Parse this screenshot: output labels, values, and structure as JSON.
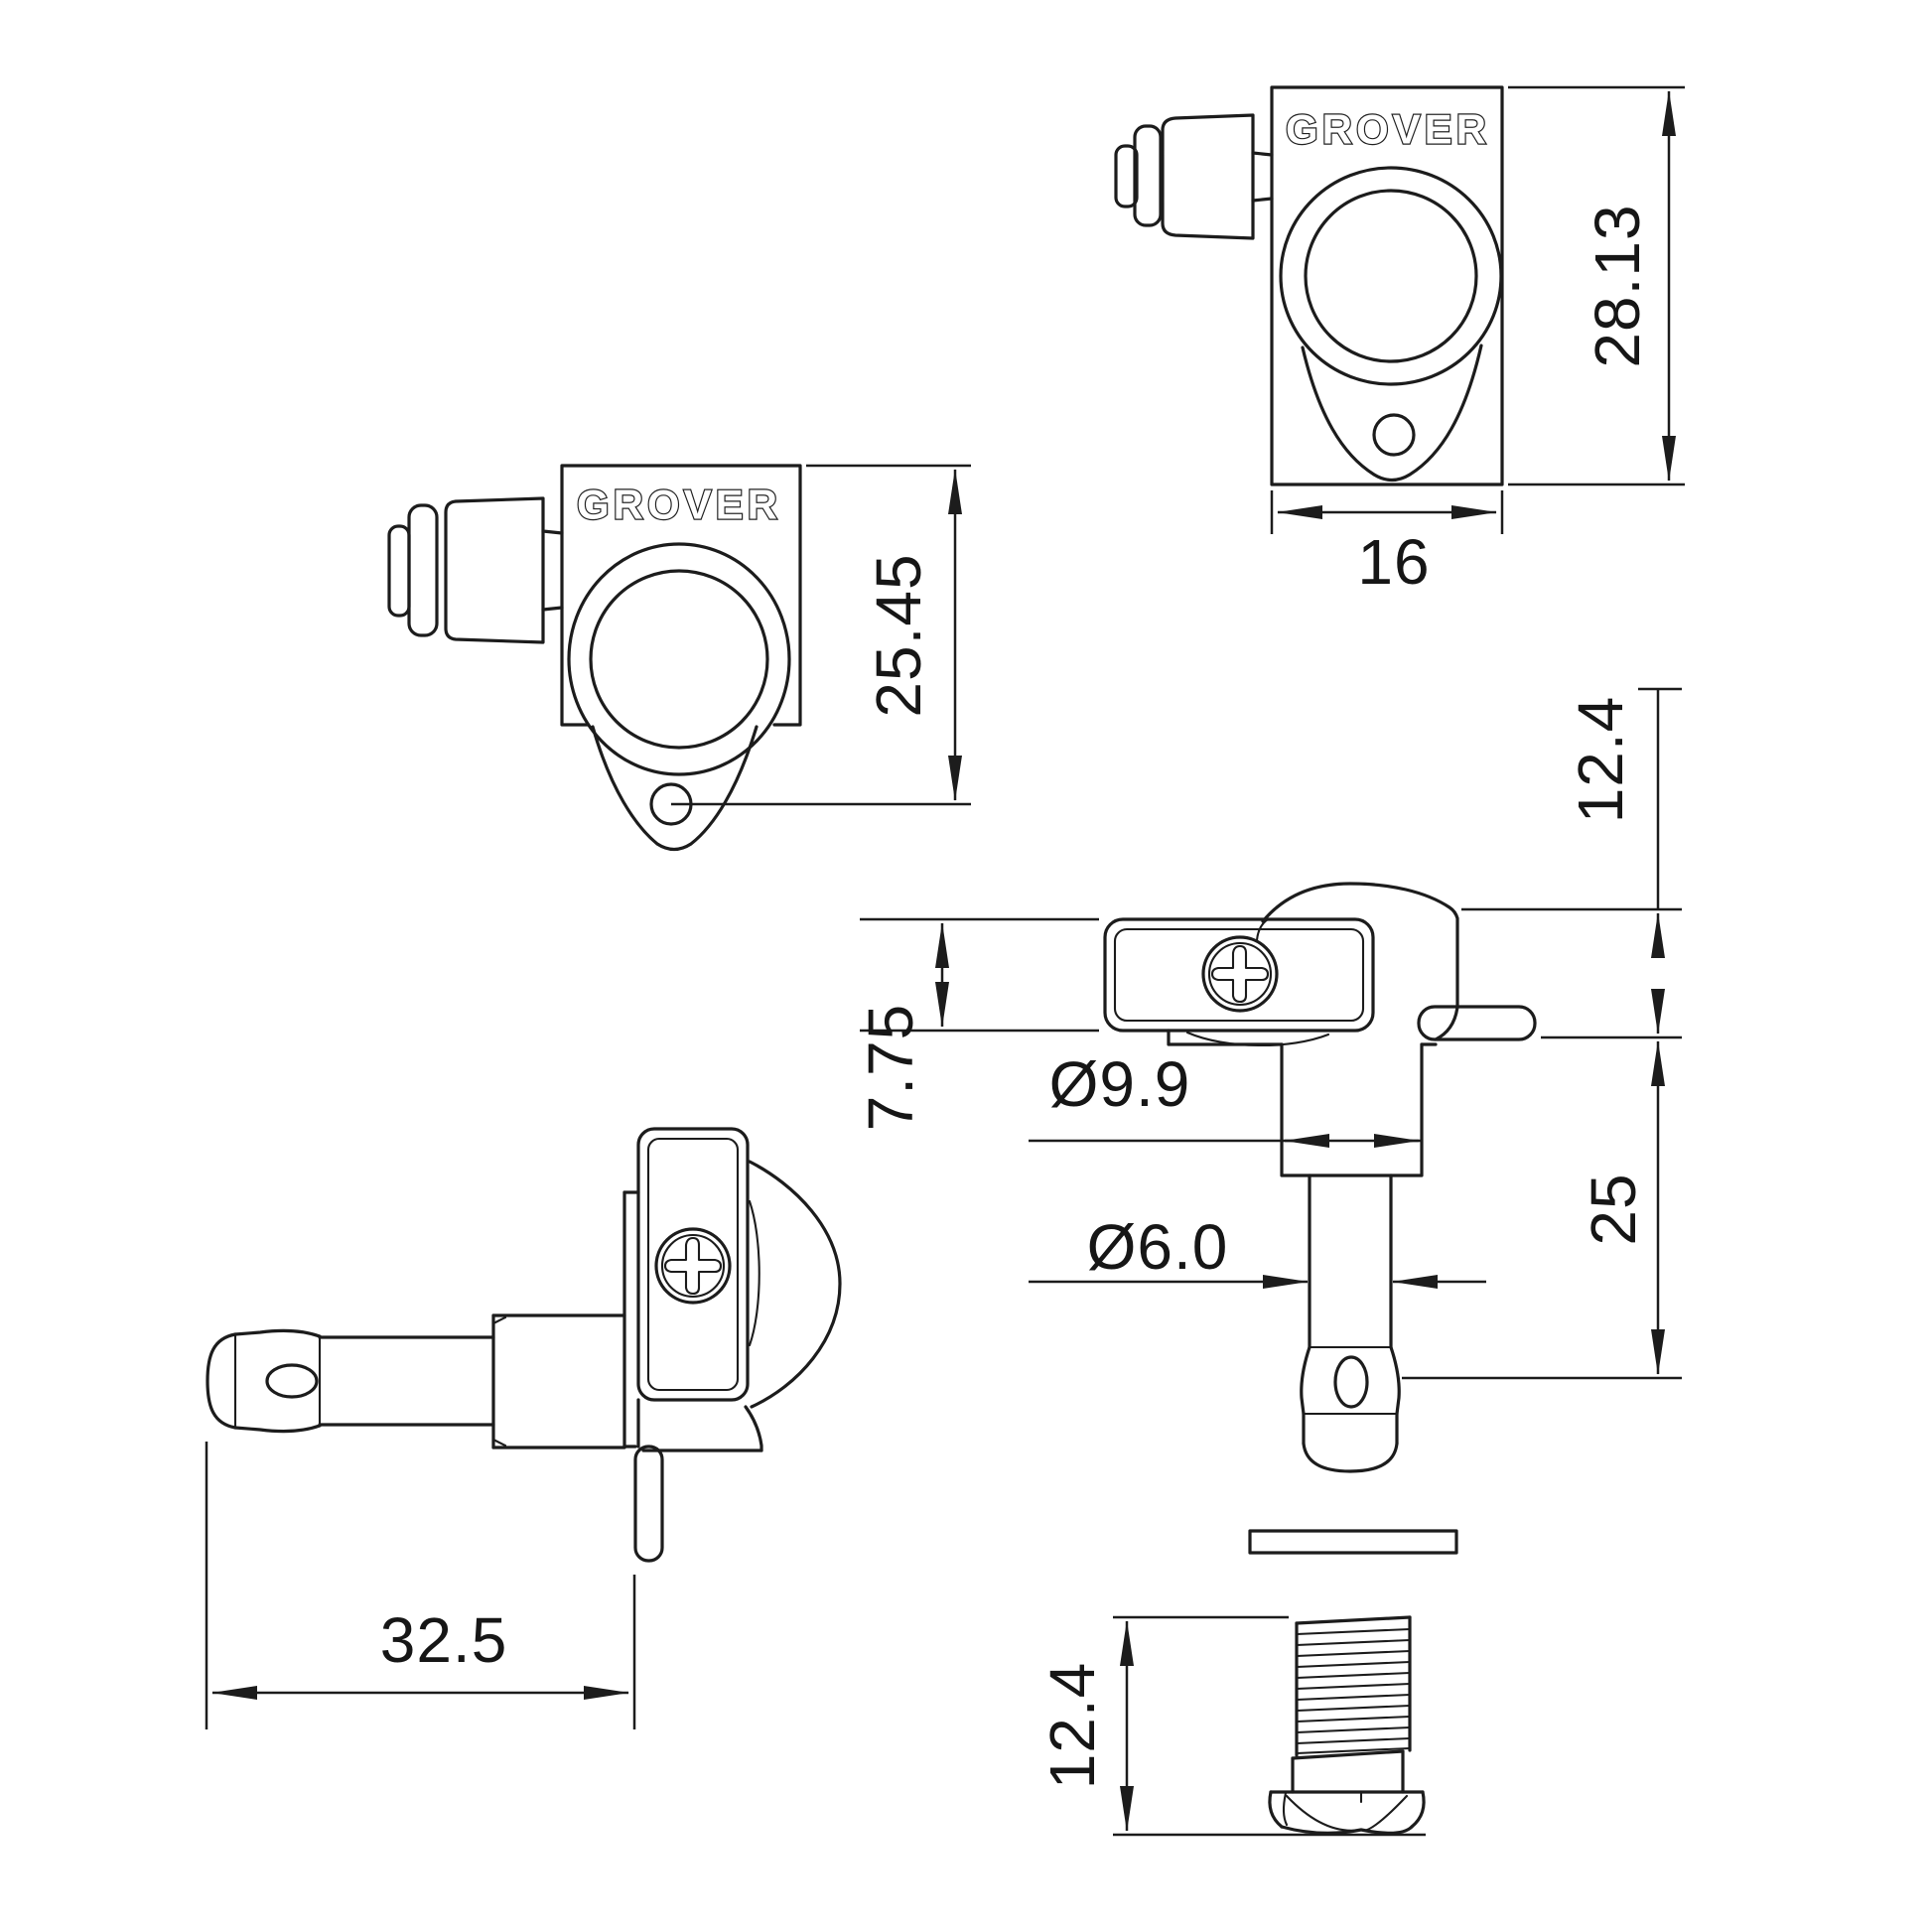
{
  "drawing_title": "Grover locking tuner dimensional drawing",
  "brand": "GROVER",
  "colors": {
    "background": "#ffffff",
    "line": "#1c1c1c",
    "text": "#161616"
  },
  "views": {
    "front_plate": {
      "brand": "GROVER",
      "dims": {
        "overall_height": "28.13",
        "plate_width": "16"
      }
    },
    "front_teardrop": {
      "brand": "GROVER",
      "dims": {
        "top_to_screw_hole": "25.45"
      }
    },
    "side_vertical": {
      "dims": {
        "above_headstock": "12.4",
        "gearbox_height": "7.75",
        "bushing_diameter": "Ø9.9",
        "post_diameter": "Ø6.0",
        "post_length": "25"
      }
    },
    "side_horizontal": {
      "dims": {
        "overall_depth": "32.5"
      }
    },
    "threaded_bushing": {
      "dims": {
        "length": "12.4"
      }
    }
  }
}
